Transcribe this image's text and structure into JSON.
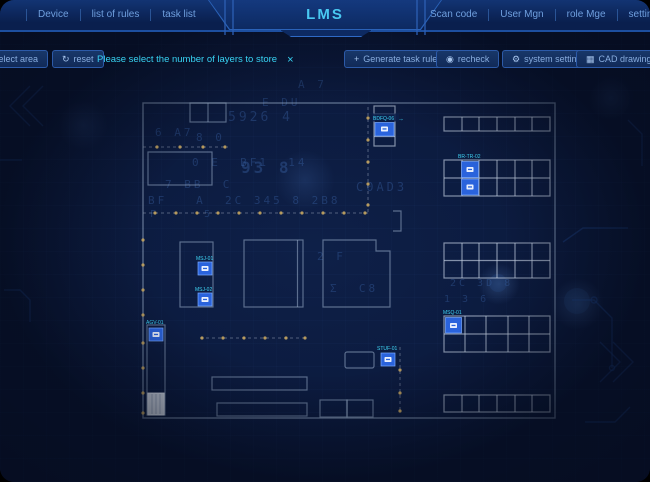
{
  "header": {
    "title": "LMS",
    "left_menu": [
      "Device",
      "list of rules",
      "task list"
    ],
    "right_menu": [
      "Scan code",
      "User Mgn",
      "role Mge",
      "settings"
    ]
  },
  "toolbar": {
    "buttons_left": [
      {
        "icon": "",
        "label": "select area"
      },
      {
        "icon": "↻",
        "label": "reset"
      }
    ],
    "message": {
      "text": "Please select the number of layers to store",
      "close": "×"
    },
    "buttons_right": [
      {
        "icon": "+",
        "label": "Generate task rules"
      },
      {
        "icon": "◉",
        "label": "recheck"
      },
      {
        "icon": "⚙",
        "label": "system settings"
      },
      {
        "icon": "▦",
        "label": "CAD drawing settings"
      }
    ]
  },
  "plan": {
    "markers": [
      {
        "id": "top-rack-device",
        "label": "BDFQ-06",
        "arrow": "→"
      },
      {
        "id": "rack2-device",
        "label": "BR-TR-02"
      },
      {
        "id": "room-a-device-1",
        "label": "MSJ-01"
      },
      {
        "id": "room-a-device-2",
        "label": "MSJ-02"
      },
      {
        "id": "corridor-device",
        "label": "AGV-01"
      },
      {
        "id": "center-device",
        "label": "STUF-01"
      },
      {
        "id": "rack4-device",
        "label": "MSQ-01"
      }
    ]
  },
  "background": {
    "glyphs": [
      {
        "text": "E DU"
      },
      {
        "text": "5926 4"
      },
      {
        "text": "6 A7"
      },
      {
        "text": "8 0"
      },
      {
        "text": "0 E  BF1  14"
      },
      {
        "text": "93 8"
      },
      {
        "text": "7 BB  C"
      },
      {
        "text": "C0AD3"
      },
      {
        "text": "BF   A  2C 345 8 2B8"
      },
      {
        "text": "F     5"
      },
      {
        "text": "2 F"
      },
      {
        "text": "Σ  C8"
      },
      {
        "text": "2C 3D 8"
      },
      {
        "text": "1 3 6"
      },
      {
        "text": "A 7"
      }
    ]
  },
  "colors": {
    "accent_cyan": "#38d3f3",
    "marker_blue": "#2a63dc",
    "plan_line": "#9db0cc",
    "dot_gold": "#c7a65f",
    "header_bg": "#0d2a62"
  }
}
